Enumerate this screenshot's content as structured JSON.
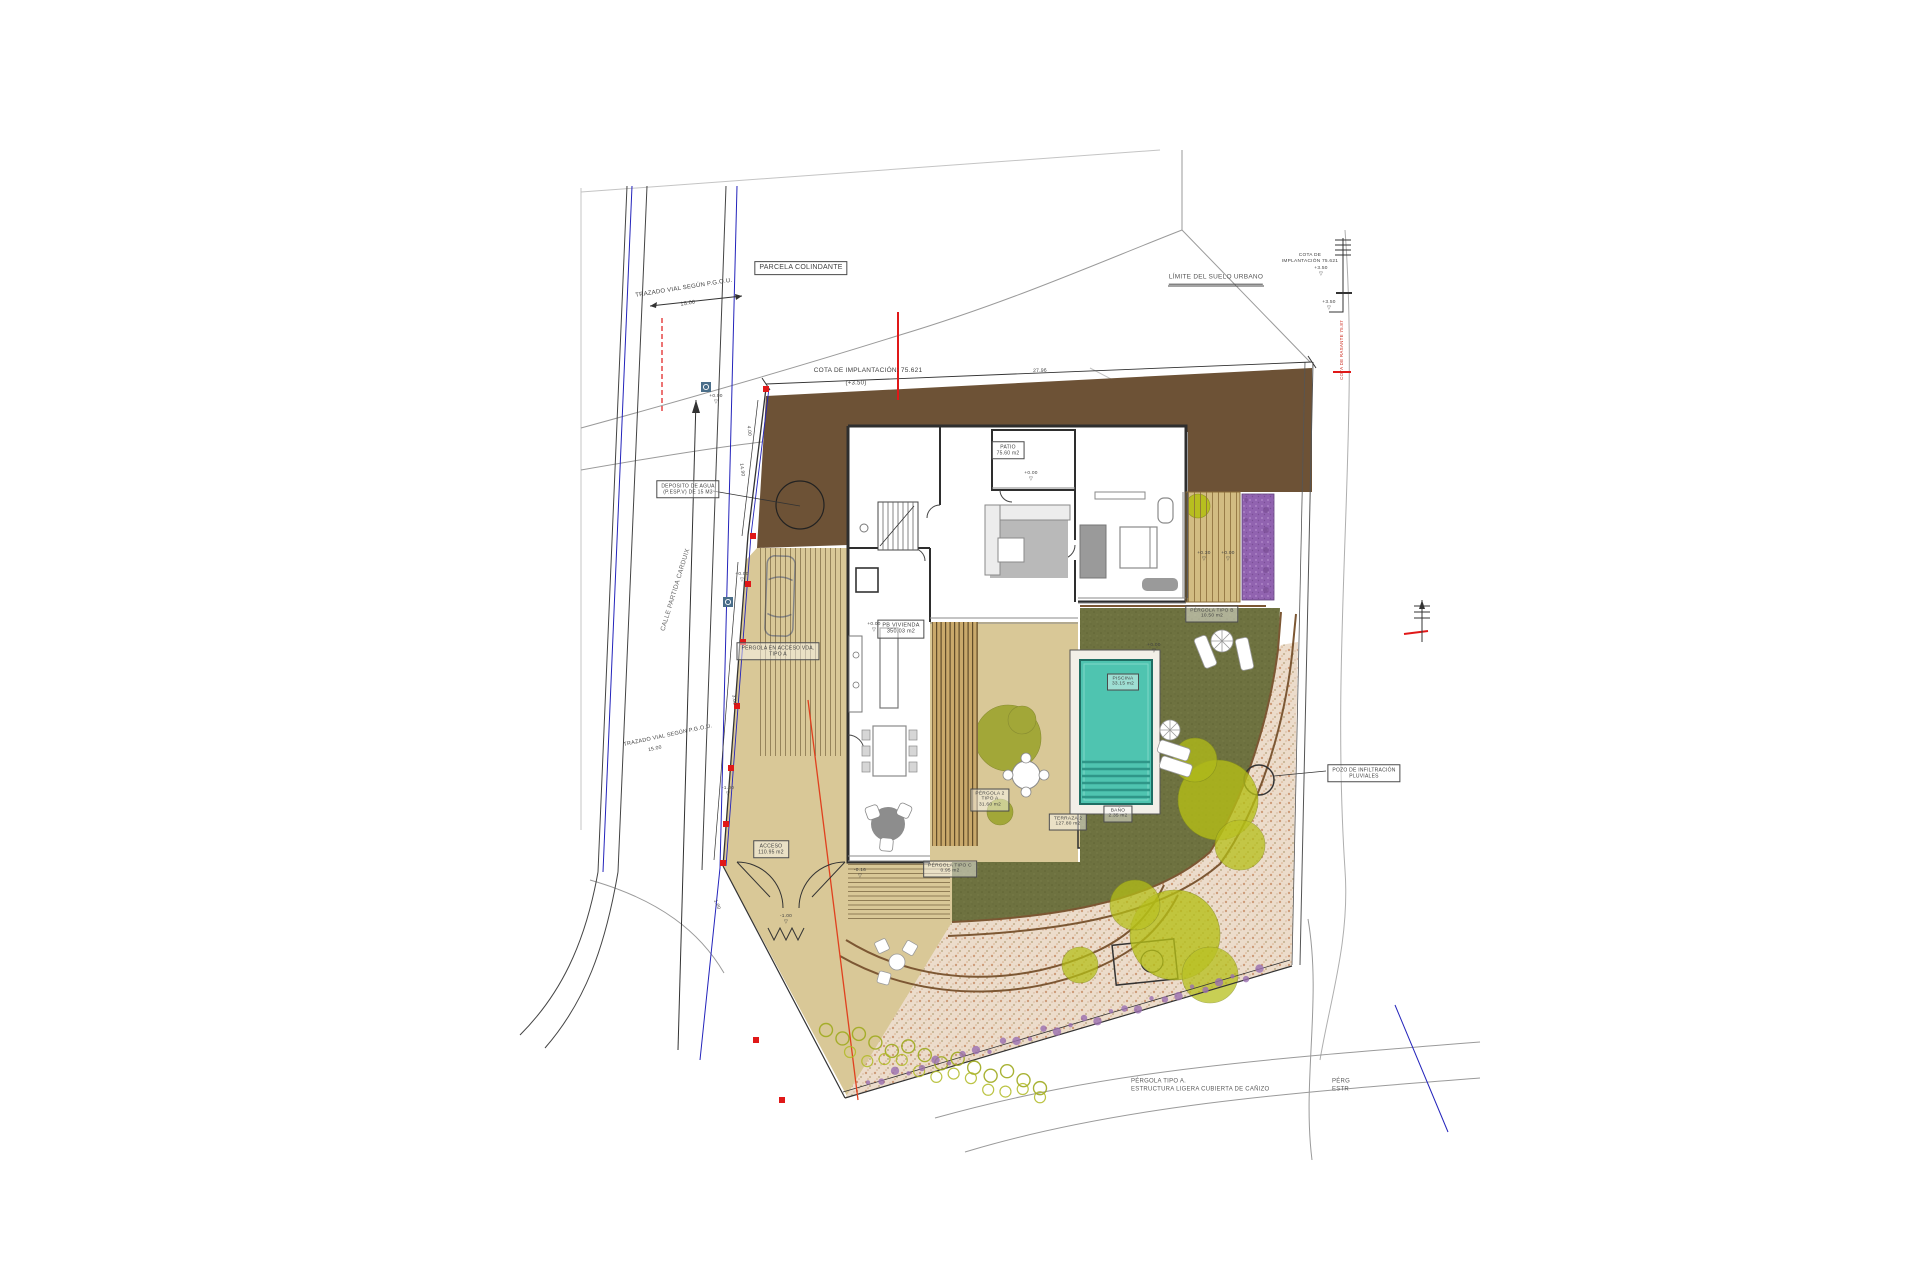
{
  "drawing": {
    "type": "architectural-site-plan",
    "street_name": "CALLE PARTIDA CARDUIX",
    "implantation_level": "75.621",
    "relative_level": "+3.50"
  },
  "palette": {
    "earth_brown": "#6d5236",
    "terrace_tan": "#d9c897",
    "deck_wood": "#caa96a",
    "lawn_olive": "#6e7240",
    "tree_bright": "#b5bf17",
    "tree_olive": "#99a228",
    "pool_teal": "#4fc4b0",
    "pool_dark": "#1f6e63",
    "purple_bed": "#9163b0",
    "gravel_base": "#ecdccb",
    "gravel_dot": "#c2875f",
    "path_brown": "#7c5733",
    "wall_dark": "#2e2e2e",
    "marker_red": "#e01818",
    "street_blue": "#2323bb",
    "contour_gray": "#9a9a9a"
  },
  "labels": [
    {
      "id": "parcela-colindante-label",
      "t": [
        "PARCELA COLINDANTE"
      ],
      "x": 801,
      "y": 268,
      "b": true,
      "s": 7
    },
    {
      "id": "limite-suelo-urbano-label",
      "t": [
        "LÍMITE DEL SUELO URBANO"
      ],
      "x": 1216,
      "y": 279,
      "s": 6.5,
      "u": true,
      "c": "#555555"
    },
    {
      "id": "cota-implantacion-label",
      "t": [
        "COTA DE IMPLANTACIÓN: 75.621"
      ],
      "x": 868,
      "y": 371,
      "s": 6.5
    },
    {
      "id": "cota-implantacion-sub",
      "t": [
        "(+3.50)"
      ],
      "x": 856,
      "y": 384,
      "s": 6
    },
    {
      "id": "trazado-vial-label-1",
      "t": [
        "TRAZADO VIAL SEGÚN P.G.O.U."
      ],
      "x": 684,
      "y": 289,
      "r": -9,
      "s": 6
    },
    {
      "id": "dim-15-00-1",
      "t": [
        "15.00"
      ],
      "x": 688,
      "y": 304,
      "r": -9,
      "s": 5.5
    },
    {
      "id": "deposito-agua-label",
      "t": [
        "DEPOSITO DE AGUA",
        "(P.ESP.V) DE 15 M3"
      ],
      "x": 688,
      "y": 489,
      "b": true,
      "s": 5
    },
    {
      "id": "calle-name-label",
      "t": [
        "CALLE PARTIDA CARDUIX"
      ],
      "x": 676,
      "y": 590,
      "r": -73,
      "s": 6.5,
      "c": "#6a6a6a"
    },
    {
      "id": "trazado-vial-label-2",
      "t": [
        "TRAZADO VIAL SEGÚN P.G.O.U."
      ],
      "x": 668,
      "y": 736,
      "r": -12,
      "s": 5.5
    },
    {
      "id": "dim-15-00-2",
      "t": [
        "15.00"
      ],
      "x": 655,
      "y": 749,
      "r": -12,
      "s": 5
    },
    {
      "id": "patio-label",
      "t": [
        "PATIO",
        "75.60 m2"
      ],
      "x": 1008,
      "y": 450,
      "b": true,
      "s": 5
    },
    {
      "id": "pb-vivienda-label",
      "t": [
        "PB VIVIENDA",
        "350.03 m2"
      ],
      "x": 901,
      "y": 629,
      "b": true,
      "s": 5.5
    },
    {
      "id": "acceso-label",
      "t": [
        "ACCESO",
        "110.95 m2"
      ],
      "x": 771,
      "y": 849,
      "b": true,
      "s": 5
    },
    {
      "id": "pergola-acceso-label",
      "t": [
        "PÉRGOLA EN ACCESO VDA.",
        "TIPO A"
      ],
      "x": 778,
      "y": 651,
      "b": true,
      "s": 5
    },
    {
      "id": "pergola-c-label",
      "t": [
        "PÉRGOLA TIPO C",
        "0.95 m2"
      ],
      "x": 950,
      "y": 869,
      "b": true,
      "s": 4.8
    },
    {
      "id": "pergola-2-label",
      "t": [
        "PÉRGOLA 2",
        "TIPO A",
        "31.60 m2"
      ],
      "x": 990,
      "y": 800,
      "b": true,
      "s": 4.8
    },
    {
      "id": "terraza-2-label",
      "t": [
        "TERRAZA 2",
        "127.80 m2"
      ],
      "x": 1068,
      "y": 822,
      "b": true,
      "s": 4.8
    },
    {
      "id": "piscina-label",
      "t": [
        "PISCINA",
        "33.15 m2"
      ],
      "x": 1123,
      "y": 682,
      "b": true,
      "s": 4.8
    },
    {
      "id": "bano-label",
      "t": [
        "BAÑO",
        "2.35 m2"
      ],
      "x": 1118,
      "y": 814,
      "b": true,
      "s": 4.8
    },
    {
      "id": "pergola-b-label",
      "t": [
        "PÉRGOLA TIPO B",
        "10.50 m2"
      ],
      "x": 1212,
      "y": 614,
      "b": true,
      "s": 4.8
    },
    {
      "id": "pozo-infiltracion-label",
      "t": [
        "POZO DE INFILTRACIÓN",
        "PLUVIALES"
      ],
      "x": 1364,
      "y": 773,
      "b": true,
      "s": 5
    },
    {
      "id": "cota-ruler-note",
      "t": [
        "COTA DE",
        "IMPLANTACIÓN 75.621"
      ],
      "x": 1310,
      "y": 259,
      "s": 4.8
    },
    {
      "id": "cota-rasante-red-note",
      "t": [
        "COTA DE RASANTE 75.87"
      ],
      "x": 1342,
      "y": 350,
      "r": -90,
      "s": 4.5,
      "c": "#cc2a1e"
    },
    {
      "id": "pergola-a-note",
      "t": [
        "PÉRGOLA TIPO A.",
        "ESTRUCTURA LIGERA CUBIERTA DE CAÑIZO"
      ],
      "x": 1131,
      "y": 1086,
      "a": "left",
      "s": 6,
      "c": "#5c5c5c"
    },
    {
      "id": "pergola-a-note-2",
      "t": [
        "PÉRG",
        "ESTR"
      ],
      "x": 1332,
      "y": 1086,
      "a": "left",
      "s": 6,
      "c": "#5c5c5c"
    },
    {
      "id": "dim-27-96",
      "t": [
        "27.96"
      ],
      "x": 1040,
      "y": 371,
      "r": -2,
      "s": 5
    },
    {
      "id": "dim-14-90",
      "t": [
        "14.90"
      ],
      "x": 741,
      "y": 470,
      "r": 83,
      "s": 4.8
    },
    {
      "id": "dim-4-00",
      "t": [
        "4.00"
      ],
      "x": 748,
      "y": 431,
      "r": 83,
      "s": 4.8
    },
    {
      "id": "dim-3-00",
      "t": [
        "3.00"
      ],
      "x": 733,
      "y": 700,
      "r": 85,
      "s": 4.8
    },
    {
      "id": "dim-1-00",
      "t": [
        "1.00"
      ],
      "x": 716,
      "y": 905,
      "r": 68,
      "s": 4.8
    },
    {
      "id": "level-patio",
      "t": [
        "+0.00",
        "▽"
      ],
      "x": 1031,
      "y": 477,
      "s": 4.8
    },
    {
      "id": "level-deck-1",
      "t": [
        "+0.30",
        "▽"
      ],
      "x": 1204,
      "y": 557,
      "s": 4.8
    },
    {
      "id": "level-deck-2",
      "t": [
        "+0.00",
        "▽"
      ],
      "x": 1228,
      "y": 557,
      "s": 4.8
    },
    {
      "id": "level-entry",
      "t": [
        "+0.00",
        "▽"
      ],
      "x": 874,
      "y": 628,
      "s": 4.8
    },
    {
      "id": "level-street",
      "t": [
        "+0.00",
        "▽"
      ],
      "x": 716,
      "y": 400,
      "s": 4.8
    },
    {
      "id": "level-drive-1",
      "t": [
        "+0.00",
        "▽"
      ],
      "x": 742,
      "y": 578,
      "s": 4.8
    },
    {
      "id": "level-drive-2",
      "t": [
        "-1.00",
        "▽"
      ],
      "x": 728,
      "y": 792,
      "s": 4.8
    },
    {
      "id": "level-ramp",
      "t": [
        "-0.16",
        "▽"
      ],
      "x": 860,
      "y": 874,
      "s": 4.8
    },
    {
      "id": "level-gate",
      "t": [
        "-1.00",
        "▽"
      ],
      "x": 786,
      "y": 920,
      "s": 4.8
    },
    {
      "id": "level-pool",
      "t": [
        "+0.00",
        "▽"
      ],
      "x": 1154,
      "y": 649,
      "s": 4.8
    },
    {
      "id": "level-ruler-1",
      "t": [
        "+3.50",
        "▽"
      ],
      "x": 1321,
      "y": 272,
      "s": 4.8
    },
    {
      "id": "level-ruler-2",
      "t": [
        "+3.50",
        "▽"
      ],
      "x": 1329,
      "y": 306,
      "s": 4.8
    }
  ]
}
